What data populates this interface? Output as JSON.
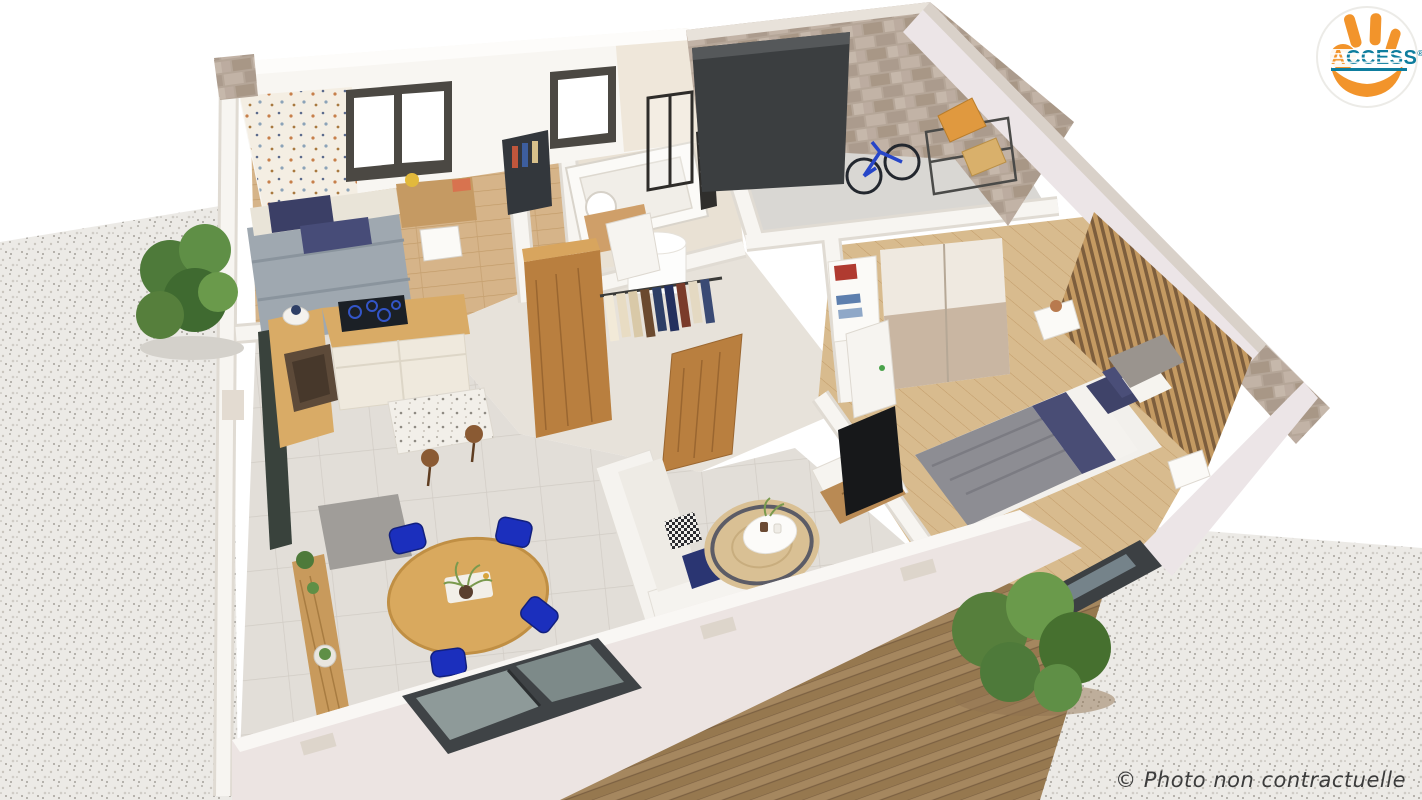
{
  "page": {
    "width": 1422,
    "height": 800,
    "background": "#ffffff",
    "description": "3D cutaway render of a single-storey house floor plan"
  },
  "branding": {
    "text_a": "A",
    "text_rest": "CCESS",
    "registered": "®",
    "text_color": "#0E7D9E",
    "hand_color": "#F2942B",
    "circle_bg": "#FFFFFF"
  },
  "caption": {
    "text": "© Photo non contractuelle",
    "color": "#3C3C3C"
  },
  "palette": {
    "gravel": "#ECEAE6",
    "gravel_speck": "#ADA9A2",
    "wall_white": "#F7F5F1",
    "wall_edge": "#E3DFD8",
    "wall_pink": "#ECE4E2",
    "stone": "#B9AA9E",
    "stone_light": "#CDBFB4",
    "tile_floor": "#E2DED8",
    "tile_line": "#D1CCC5",
    "wood_floor": "#D6B489",
    "wood_furniture": "#C1883F",
    "deck": "#A5875F",
    "deck_dark": "#8F7250",
    "door_dark": "#3C4043",
    "garage_door": "#3B3E40",
    "sofa_white": "#F5F3EF",
    "rug_jute": "#D9C094",
    "navy": "#2A3572",
    "royal_blue": "#1B2FBD",
    "duvet_gray": "#9FA8B0",
    "bed_gray": "#8D8D93",
    "slat_wood": "#C49A62",
    "plant_green": "#4E7A3A",
    "cooktop_black": "#1B2026",
    "box_orange": "#E0993F"
  },
  "scene": {
    "rooms": [
      "kids-bedroom",
      "bathroom",
      "garage",
      "dressing",
      "master-bedroom",
      "kitchen",
      "dining-area",
      "living-room",
      "hallway",
      "terrace-deck",
      "gravel-yard-left",
      "gravel-yard-right"
    ]
  }
}
